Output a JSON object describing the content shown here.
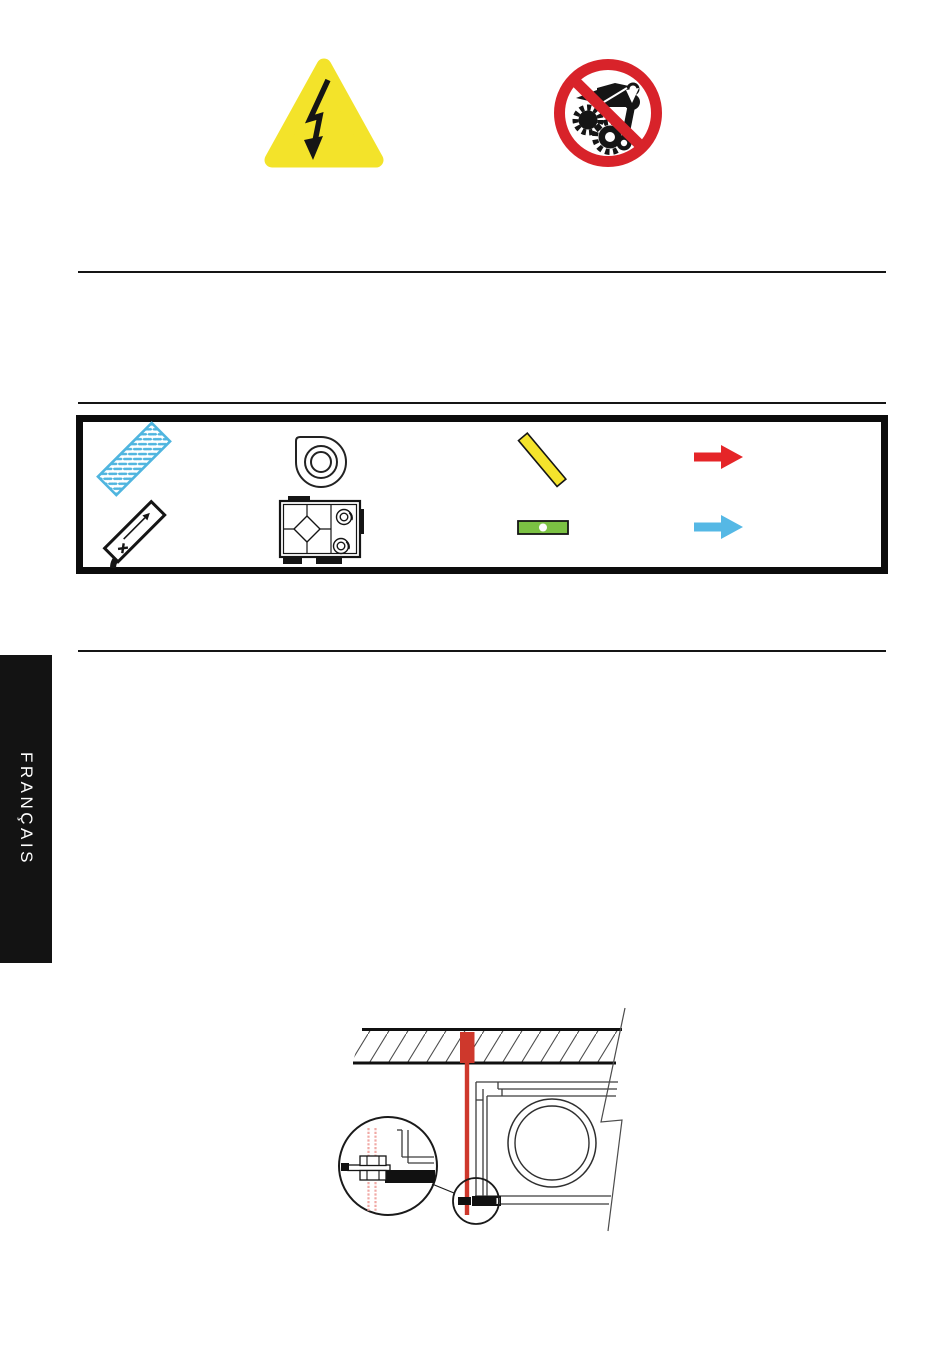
{
  "page": {
    "language_tab": "FRANÇAIS",
    "background": "#ffffff"
  },
  "header": {
    "warning_icons": [
      {
        "name": "high-voltage-warning-triangle"
      },
      {
        "name": "no-unauthorized-repair-prohibition-sign"
      }
    ]
  },
  "legend": {
    "items": [
      {
        "name": "air-filter"
      },
      {
        "name": "fan"
      },
      {
        "name": "shut-off-damper"
      },
      {
        "name": "extract-air-arrow"
      },
      {
        "name": "electric-heating-battery"
      },
      {
        "name": "heat-recovery-unit"
      },
      {
        "name": "spirit-level"
      },
      {
        "name": "supply-air-arrow"
      }
    ]
  },
  "drawing": {
    "name": "ceiling-suspension-mounting-detail"
  },
  "colors": {
    "warning_yellow": "#F3E32A",
    "prohibition_red": "#D8232A",
    "filter_blue": "#4FB5DF",
    "damper_yellow": "#F4E32C",
    "level_green": "#7BC143",
    "arrow_red": "#E52528",
    "arrow_blue": "#55B8E5",
    "anchor_red": "#CE382C",
    "thread_pink": "#F0A9A5",
    "ink_black": "#151515",
    "tab_background": "#131313",
    "tab_text": "#FFFFFF"
  }
}
